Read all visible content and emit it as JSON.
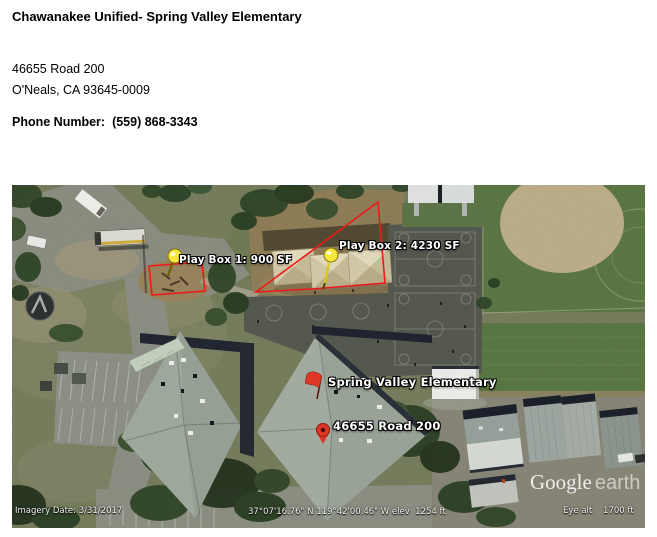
{
  "header": {
    "title": "Chawanakee Unified- Spring Valley Elementary",
    "address_line1": "46655 Road 200",
    "address_line2": "O'Neals, CA 93645-0009",
    "phone_label": "Phone Number:",
    "phone_number": "(559) 868-3343"
  },
  "map": {
    "annotations": {
      "play_box_1": "Play Box 1: 900 SF",
      "play_box_2": "Play Box 2: 4230 SF",
      "school_name": "Spring Valley Elementary",
      "street_address": "46655 Road 200"
    },
    "watermark": {
      "google": "Google",
      "earth": "earth"
    },
    "status": {
      "imagery_date": "Imagery Date: 3/31/2017",
      "coordinates": "37°07'16.76\" N 119°42'00.46\" W elev  1254 ft",
      "eye_alt": "Eye alt    1700 ft"
    },
    "colors": {
      "annotation_red": "#f01818",
      "pushpin_yellow": "#f8e83e",
      "marker_red": "#df3726"
    }
  }
}
